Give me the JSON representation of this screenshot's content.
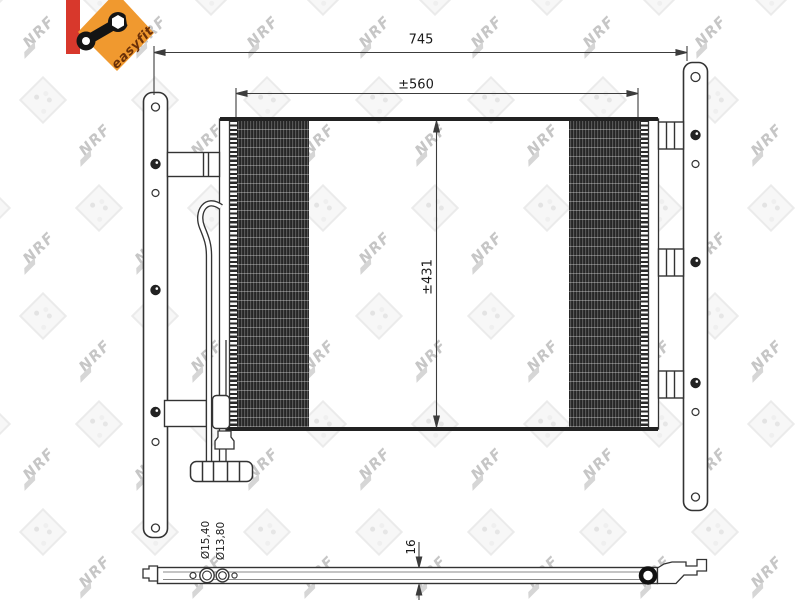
{
  "branding": {
    "easyfit_label": "easyfit",
    "accent_red": "#d8382c",
    "accent_orange": "#f0992f"
  },
  "watermark": {
    "text": "NRF"
  },
  "dimensions": {
    "overall_width_mm": "745",
    "core_width_mm": "±560",
    "core_height_mm": "±431",
    "thickness_mm": "16",
    "port_diameter_large": "Ø15,40",
    "port_diameter_small": "Ø13,80"
  }
}
